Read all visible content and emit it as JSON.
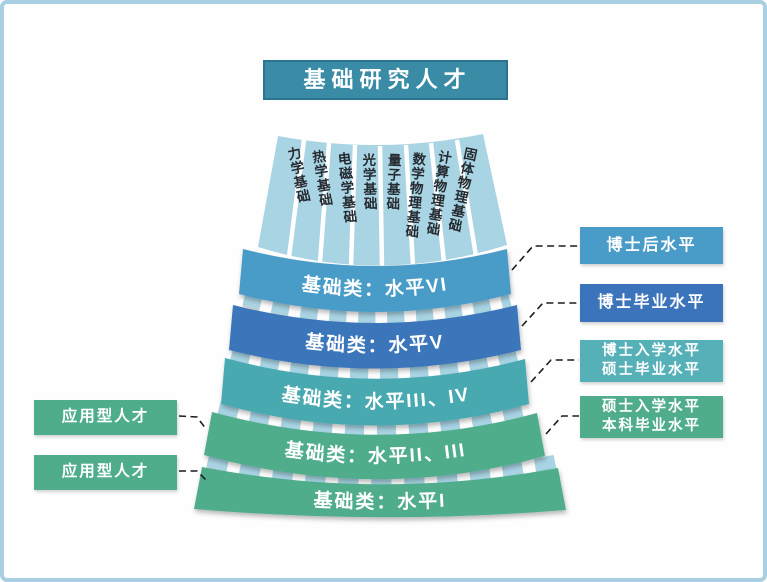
{
  "title": {
    "text": "基础研究人才"
  },
  "colors": {
    "frame_border": "#a9cfe2",
    "title_bg": "#3a8ca6",
    "title_border": "#2a7490",
    "strip_fill": "#a8d4e4",
    "level6_blue": "#4a9cc8",
    "level5_blue": "#3b74ba",
    "level34_teal": "#48a9b1",
    "green": "#4fad8c",
    "callout_teal": "#55b0b8",
    "connector": "#1c1c1c"
  },
  "fan": {
    "subjects": [
      "力学基础",
      "热学基础",
      "电磁学基础",
      "光学基础",
      "量子基础",
      "数学物理基础",
      "计算物理基础",
      "固体物理基础"
    ],
    "levels": [
      {
        "label": "基础类：水平VI",
        "color": "#4a9cc8"
      },
      {
        "label": "基础类：水平V",
        "color": "#3b74ba"
      },
      {
        "label": "基础类：水平III、IV",
        "color": "#48a9b1"
      },
      {
        "label": "基础类：水平II、III",
        "color": "#4fad8c"
      },
      {
        "label": "基础类：水平I",
        "color": "#4fad8c"
      }
    ]
  },
  "right_callouts": [
    {
      "lines": [
        "博士后水平"
      ],
      "color": "#4a9cc8"
    },
    {
      "lines": [
        "博士毕业水平"
      ],
      "color": "#3b74ba"
    },
    {
      "lines": [
        "博士入学水平",
        "硕士毕业水平"
      ],
      "color": "#55b0b8"
    },
    {
      "lines": [
        "硕士入学水平",
        "本科毕业水平"
      ],
      "color": "#4fad8c"
    }
  ],
  "left_callouts": [
    {
      "lines": [
        "应用型人才"
      ],
      "color": "#4fad8c"
    },
    {
      "lines": [
        "应用型人才"
      ],
      "color": "#4fad8c"
    }
  ]
}
